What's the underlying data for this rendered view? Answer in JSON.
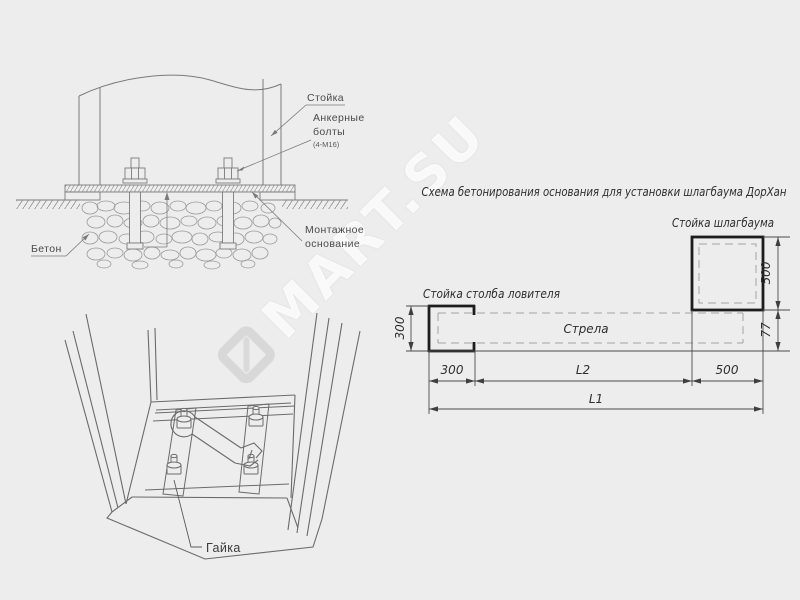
{
  "colors": {
    "background": "#ededed",
    "drawing_line": "#7a7a7a",
    "perspective_line": "#6b6b6b",
    "thick_outline": "#1c1c1c",
    "dimension_line": "#4a4a4a",
    "dashed_line": "#a3a3a3",
    "label_text": "#4a4a4a",
    "title_text": "#2e2e2e",
    "watermark_text": "rgba(255,255,255,0.85)"
  },
  "watermark": {
    "text": "MART.SU"
  },
  "cross_section": {
    "labels": {
      "post": "Стойка",
      "anchor_bolts_line1": "Анкерные",
      "anchor_bolts_line2": "болты",
      "anchor_bolts_spec": "(4-М16)",
      "concrete": "Бетон",
      "mounting_base_line1": "Монтажное",
      "mounting_base_line2": "основание"
    }
  },
  "perspective_view": {
    "labels": {
      "nut": "Гайка"
    }
  },
  "plan_view": {
    "title": "Схема бетонирования основания для установки шлагбаума ДорХан",
    "labels": {
      "barrier_post": "Стойка шлагбаума",
      "catcher_post": "Стойка столба ловителя",
      "boom": "Стрела"
    },
    "dimensions": {
      "catcher_height": "300",
      "catcher_width_bottom": "300",
      "barrier_height": "500",
      "barrier_width_bottom": "500",
      "boom_offset": "77",
      "mid_span": "L2",
      "total_span": "L1"
    }
  }
}
